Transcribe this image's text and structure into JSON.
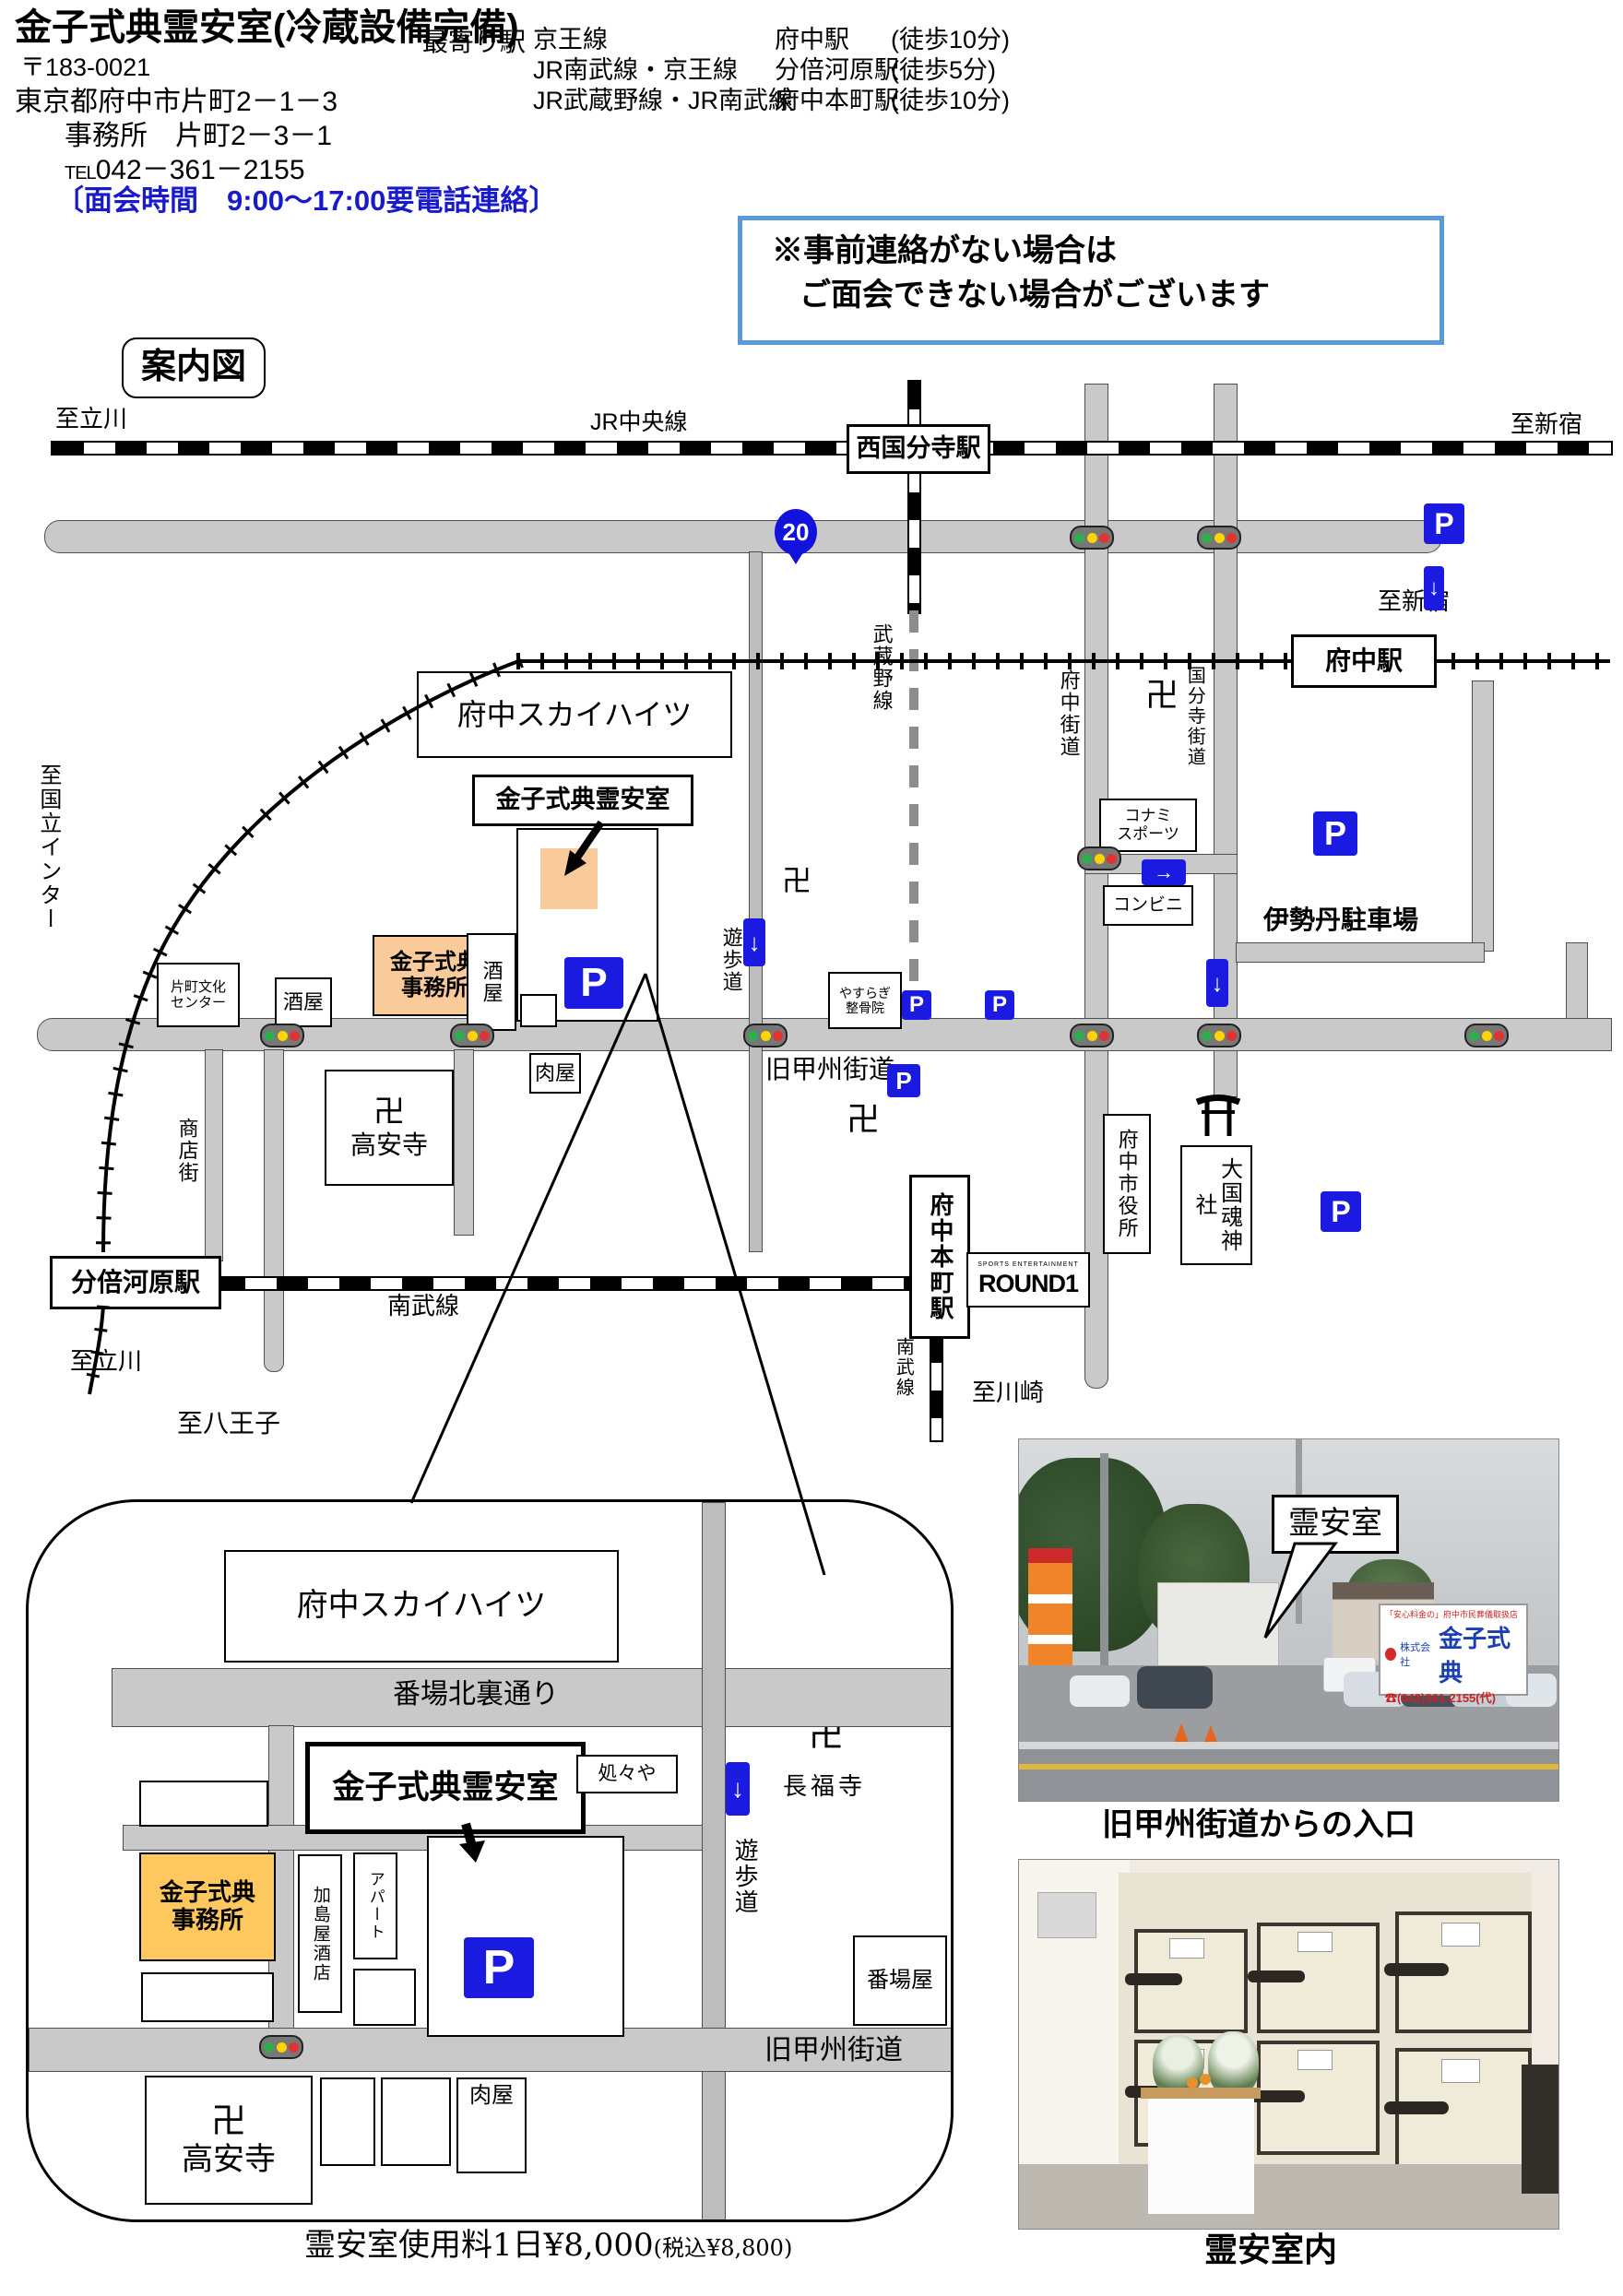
{
  "header": {
    "title": "金子式典霊安室(冷蔵設備完備)",
    "postal_code": "〒183-0021",
    "address": "東京都府中市片町2－1－3",
    "office_address": "事務所　片町2－3－1",
    "tel_label": "TEL",
    "tel_number": "042－361－2155",
    "visiting_hours": "〔面会時間　9:00～17:00要電話連絡〕"
  },
  "stations_info": {
    "label": "最寄り駅",
    "rows": [
      {
        "line": "京王線",
        "station": "府中駅",
        "walk": "(徒歩10分)"
      },
      {
        "line": "JR南武線・京王線",
        "station": "分倍河原駅",
        "walk": "(徒歩5分)"
      },
      {
        "line": "JR武蔵野線・JR南武線",
        "station": "府中本町駅",
        "walk": "(徒歩10分)"
      }
    ]
  },
  "notice": {
    "line1": "※事前連絡がない場合は",
    "line2": "ご面会できない場合がございます"
  },
  "map": {
    "title": "案内図",
    "directions": {
      "tachikawa": "至立川",
      "shinjuku": "至新宿",
      "hachioji": "至八王子",
      "kawasaki": "至川崎",
      "kunitachi_inter": "至国立インター"
    },
    "railways": {
      "chuo": "JR中央線",
      "musashino": "武蔵野線",
      "keio": "京王線",
      "nambu": "南武線"
    },
    "stations": {
      "nishikokubunji": "西国分寺駅",
      "fuchu": "府中駅",
      "bubaigawara": "分倍河原駅",
      "fuchu_honmachi": "府中本町駅"
    },
    "roads": {
      "route20": "20",
      "kyu_koshu_kaido": "旧甲州街道",
      "fuchu_kaido": "府中街道",
      "kokubunji_kaido": "国分寺街道",
      "shotengai": "商店街",
      "yuhodo": "遊歩道"
    },
    "places": {
      "fuchu_sky_heights": "府中スカイハイツ",
      "kaneko_reianshitsu": "金子式典霊安室",
      "kaneko_office_line1": "金子式典",
      "kaneko_office_line2": "事務所",
      "sakaya": "酒屋",
      "nikuya": "肉屋",
      "katamachi_bunka_line1": "片町文化",
      "katamachi_bunka_line2": "センター",
      "takaanji": "高安寺",
      "manji": "卍",
      "yasuragi_line1": "やすらぎ",
      "yasuragi_line2": "整骨院",
      "konami_line1": "コナミ",
      "konami_line2": "スポーツ",
      "conbini": "コンビニ",
      "isetan_parking": "伊勢丹駐車場",
      "okunitama_jinja": "大国魂神社",
      "fuchu_shiyakusho": "府中市役所",
      "round1_sub": "SPORTS ENTERTAINMENT",
      "round1": "ROUND1"
    }
  },
  "inset": {
    "bamba_kita_ura_dori": "番場北裏通り",
    "shoshoya": "処々や",
    "chofukuji": "長福寺",
    "kashimaya_saketen": "加島屋酒店",
    "apartment": "アパート",
    "bambaya": "番場屋",
    "price_main": "霊安室使用料1日¥8,000",
    "price_tax": "(税込¥8,800)"
  },
  "photos": {
    "callout": "霊安室",
    "caption_entrance": "旧甲州街道からの入口",
    "caption_interior": "霊安室内",
    "sign_top": "「安心料金の」府中市民葬儀取扱店",
    "sign_company": "株式会社",
    "sign_name": "金子式典",
    "sign_tel": "☎(042)361-2155(代)"
  },
  "icons": {
    "parking": "P",
    "down_arrow": "↓",
    "right_arrow": "→"
  },
  "colors": {
    "accent_blue": "#1a1ae0",
    "notice_border": "#5b9bd5",
    "road_gray": "#c9c9c9",
    "building_orange": "#f9cb9b",
    "building_gold": "#ffc85e"
  }
}
